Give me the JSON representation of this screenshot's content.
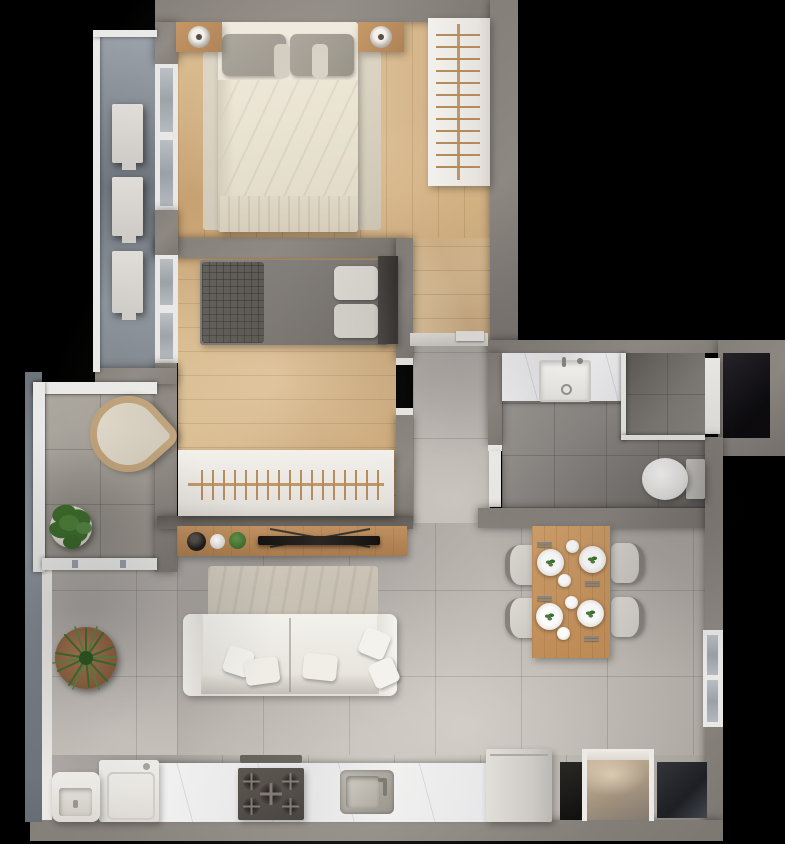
{
  "meta": {
    "kind": "3d-rendered-floor-plan",
    "view": "top-down",
    "width_px": 785,
    "height_px": 844,
    "visible_text": "none"
  },
  "palette": {
    "bg": "#000000",
    "wall": "#857f79",
    "wall_dark": "#6b6660",
    "wood": "#d0ad7e",
    "tile_light": "#b8b3ad",
    "tile_bath": "#827e7a",
    "terrace_tile": "#a19c95",
    "furniture_white": "#eceae6",
    "marble": "#ebebed",
    "console_wood": "#b5885c",
    "table_wood": "#c5945f",
    "sofa_white": "#f0eee9",
    "bed_duvet": "#e8e2d3",
    "pillow_gray": "#9d988f",
    "bed2_dark": "#7b7773",
    "plant_green": "#44722f",
    "pot_terracotta": "#9a6a48",
    "niche_black": "#191715",
    "steel": "#a5a19a"
  },
  "rooms": [
    {
      "name": "master-bedroom",
      "floor": "wood",
      "items": [
        "double-bed",
        "area-rug",
        "nightstand-left",
        "lamp-left",
        "nightstand-right",
        "lamp-right",
        "closet-wardrobe-with-hangers"
      ]
    },
    {
      "name": "second-bedroom",
      "floor": "wood",
      "items": [
        "single-bed",
        "knit-blanket",
        "stacked-pillows",
        "tall-dark-cabinet",
        "open-wardrobe-hanging-rail"
      ]
    },
    {
      "name": "service-balcony",
      "floor": "tile",
      "items": [
        "glass-railing",
        "ac-unit-1",
        "ac-unit-2",
        "ac-unit-3"
      ]
    },
    {
      "name": "terrace",
      "floor": "tile",
      "items": [
        "glass-enclosure",
        "wicker-lounge-chair",
        "potted-plant"
      ]
    },
    {
      "name": "living-room",
      "floor": "tile",
      "items": [
        "two-seat-sofa",
        "throw-pillows",
        "rug",
        "tv-console",
        "flat-tv",
        "black-bowl",
        "white-bowl",
        "moss-ball",
        "potted-plant"
      ]
    },
    {
      "name": "dining-area",
      "floor": "tile",
      "items": [
        "wood-dining-table",
        "dining-chairs",
        "set-plates",
        "small-bowls",
        "cutlery",
        "side-window"
      ]
    },
    {
      "name": "bathroom",
      "floor": "tile",
      "items": [
        "vanity-counter",
        "basin-sink",
        "shower",
        "glass-partition",
        "toilet",
        "door-leaf",
        "service-shaft"
      ]
    },
    {
      "name": "hallway",
      "floor": "tile",
      "items": [
        "door-threshold",
        "open-door-pictogram"
      ]
    },
    {
      "name": "kitchen-laundry",
      "floor": "tile",
      "items": [
        "laundry-tub",
        "washing-machine",
        "marble-countertop",
        "gas-cooktop-5-burner",
        "range-shelf",
        "kitchen-sink",
        "refrigerator",
        "entry-doorway",
        "dark-niche-left",
        "dark-niche-right"
      ]
    }
  ],
  "counts": {
    "ac_units": 3,
    "dining_chairs": 4,
    "plates": 4,
    "small_bowls": 4,
    "stove_burners": 5,
    "sofa_seats": 2,
    "plants": 2,
    "windows_left": 2,
    "window_right": 1
  }
}
